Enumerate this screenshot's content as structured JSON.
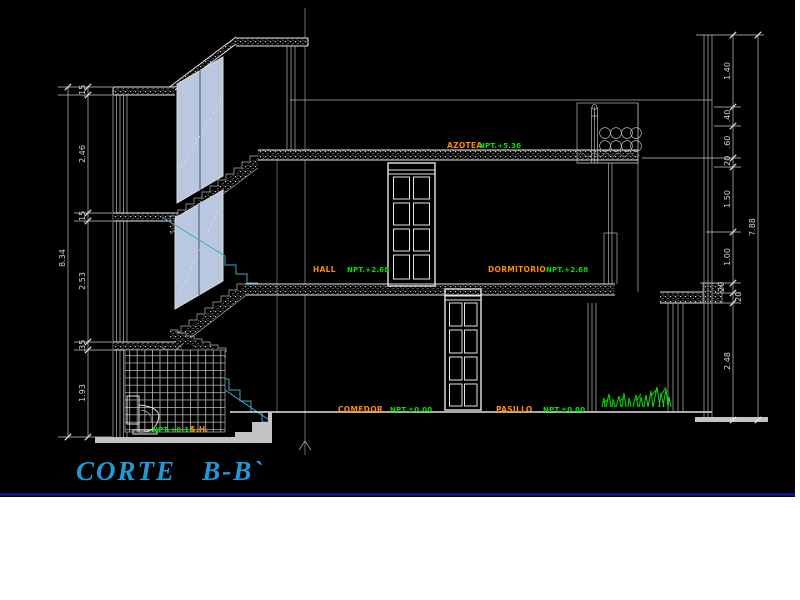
{
  "drawing": {
    "title": "CORTE   B-B`",
    "rooms": {
      "azotea": {
        "label": "AZOTEA",
        "level": "NPT.+5.36"
      },
      "hall": {
        "label": "HALL",
        "level": "NPT.+2.68"
      },
      "dormitorio": {
        "label": "DORMITORIO",
        "level": "NPT.+2.68"
      },
      "comedor": {
        "label": "COMEDOR",
        "level": "NPT.±0.00"
      },
      "pasillo": {
        "label": "PASILLO",
        "level": "NPT.±0.00"
      },
      "sh": {
        "label": "S.H.",
        "level": "NPT.+0.15"
      }
    },
    "dimensions": {
      "left": {
        "total": "8.34",
        "segments": [
          ".15",
          "2.46",
          ".15",
          "2.53",
          ".35",
          "1.93"
        ]
      },
      "right": {
        "total": "7.88",
        "segments": [
          "1.40",
          ".40",
          ".60",
          ".20",
          "1.50",
          "1.00",
          ".20",
          ".20",
          "2.48"
        ]
      }
    },
    "colors": {
      "background": "#000000",
      "paper": "#ffffff",
      "line": "#e6e6e6",
      "dimension": "#d4d4d4",
      "room_label": "#ff8a00",
      "level_label": "#00e100",
      "title": "#1f9ad6",
      "stairs": "#3fa8c8",
      "glass": "#b9c7df",
      "plants": "#00c800",
      "border": "#15159b"
    }
  }
}
